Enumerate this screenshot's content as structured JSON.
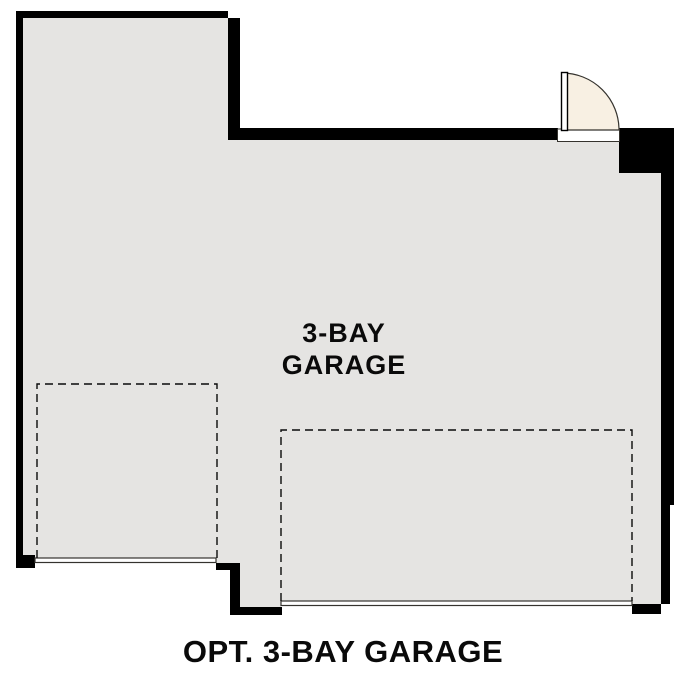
{
  "plan": {
    "room_label_line1": "3-BAY",
    "room_label_line2": "GARAGE",
    "caption": "OPT. 3-BAY GARAGE"
  },
  "colors": {
    "background": "#ffffff",
    "wall": "#000000",
    "floor": "#e5e4e2",
    "door": "#f8f0e3",
    "line": "#35332e",
    "text": "#0a0a0a",
    "sill": "#ffffff"
  }
}
